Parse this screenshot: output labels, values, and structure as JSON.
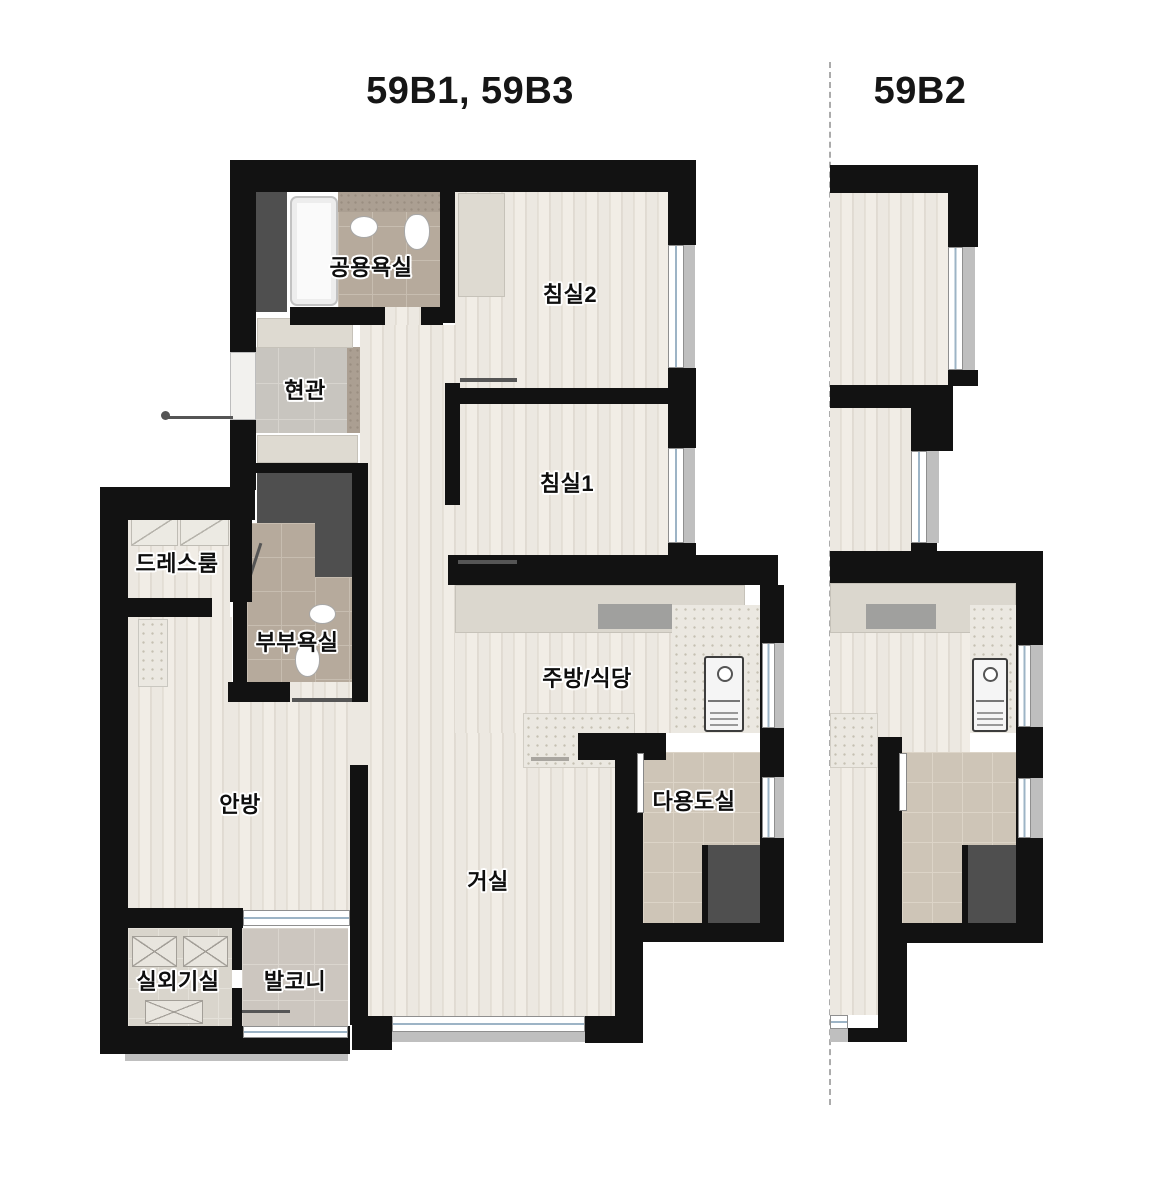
{
  "titles": {
    "left": "59B1, 59B3",
    "right": "59B2"
  },
  "rooms": {
    "bathroom_common": {
      "label": "공용욕실"
    },
    "entrance": {
      "label": "현관"
    },
    "bedroom2": {
      "label": "침실2"
    },
    "bedroom1": {
      "label": "침실1"
    },
    "dressroom": {
      "label": "드레스룸"
    },
    "bathroom_master": {
      "label": "부부욕실"
    },
    "kitchen": {
      "label": "주방/식당"
    },
    "master_bedroom": {
      "label": "안방"
    },
    "utility": {
      "label": "다용도실"
    },
    "living": {
      "label": "거실"
    },
    "ac_room": {
      "label": "실외기실"
    },
    "balcony": {
      "label": "발코니"
    }
  },
  "colors": {
    "wall": "#121212",
    "wood_floor": "#e9e5dd",
    "bath_tile": "#b6aa9c",
    "entrance_tile": "#c8c5bf",
    "utility_tile": "#cec5b7",
    "balcony_tile": "#ccc6bf",
    "counter": "#dbd7ce",
    "appliance_dark": "#4f4f4f",
    "window_line": "#9db4c6"
  }
}
